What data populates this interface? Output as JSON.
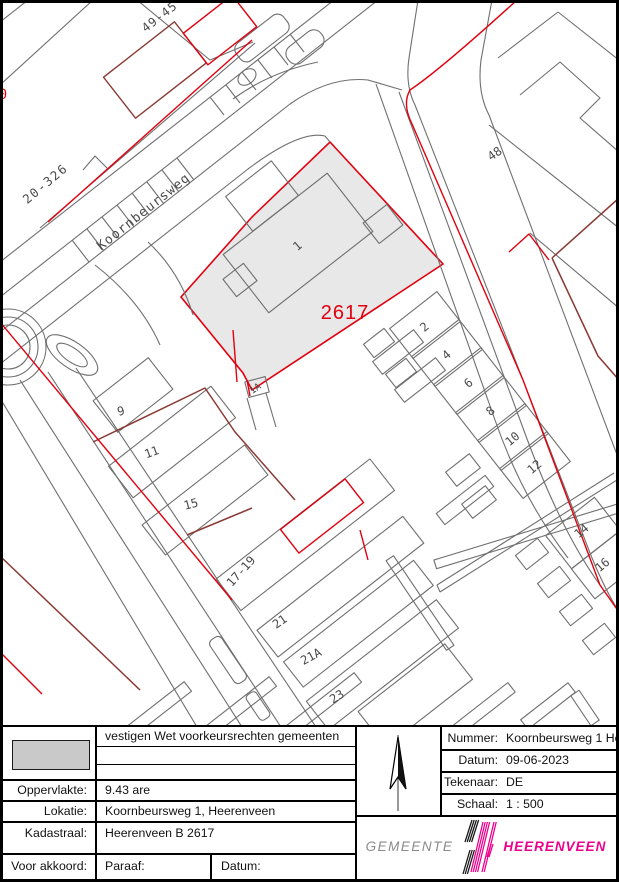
{
  "map": {
    "colors": {
      "gray_line": "#6f6f6f",
      "red": "#e2000f",
      "maroon": "#8a3a34",
      "parcel_fill": "#e8e8e8",
      "label": "#4a4a4a",
      "parcel_number_red": "#e2000f"
    },
    "street_label": "Koornbeursweg",
    "subject_parcel_number": "2617",
    "labels": [
      {
        "text": "0",
        "x": 3,
        "y": 99,
        "rot": 0,
        "size": 14,
        "color": "#e2000f"
      },
      {
        "text": "49-45",
        "x": 162,
        "y": 20,
        "rot": -38,
        "size": 12,
        "ls": 1
      },
      {
        "text": "20-326",
        "x": 48,
        "y": 187,
        "rot": -40,
        "size": 12.5,
        "ls": 1.5
      },
      {
        "text": "Koornbeursweg",
        "x": 146,
        "y": 215,
        "rot": -38.5,
        "size": 13,
        "ls": 1
      },
      {
        "text": "48",
        "x": 497,
        "y": 157,
        "rot": -35,
        "size": 12
      },
      {
        "text": "1",
        "x": 300,
        "y": 249,
        "rot": -40,
        "size": 12
      },
      {
        "text": "2617",
        "x": 345,
        "y": 319,
        "rot": 0,
        "size": 20,
        "color": "#e2000f",
        "font": "sans",
        "ls": 1
      },
      {
        "text": "1A",
        "x": 257,
        "y": 391,
        "rot": -35,
        "size": 9.5
      },
      {
        "text": "2",
        "x": 427,
        "y": 330,
        "rot": -40,
        "size": 12
      },
      {
        "text": "4",
        "x": 449,
        "y": 358,
        "rot": -40,
        "size": 12
      },
      {
        "text": "6",
        "x": 471,
        "y": 386,
        "rot": -40,
        "size": 12
      },
      {
        "text": "8",
        "x": 493,
        "y": 414,
        "rot": -40,
        "size": 12
      },
      {
        "text": "10",
        "x": 515,
        "y": 442,
        "rot": -40,
        "size": 12
      },
      {
        "text": "12",
        "x": 537,
        "y": 470,
        "rot": -40,
        "size": 12
      },
      {
        "text": "9",
        "x": 122,
        "y": 415,
        "rot": -15,
        "size": 12
      },
      {
        "text": "11",
        "x": 153,
        "y": 456,
        "rot": -20,
        "size": 12
      },
      {
        "text": "15",
        "x": 192,
        "y": 508,
        "rot": -15,
        "size": 12
      },
      {
        "text": "17-19",
        "x": 244,
        "y": 574,
        "rot": -48,
        "size": 12
      },
      {
        "text": "21",
        "x": 282,
        "y": 625,
        "rot": -35,
        "size": 12
      },
      {
        "text": "21A",
        "x": 313,
        "y": 660,
        "rot": -28,
        "size": 12
      },
      {
        "text": "23",
        "x": 339,
        "y": 700,
        "rot": -32,
        "size": 12
      },
      {
        "text": "14",
        "x": 584,
        "y": 534,
        "rot": -40,
        "size": 12
      },
      {
        "text": "16",
        "x": 605,
        "y": 568,
        "rot": -40,
        "size": 12
      }
    ]
  },
  "title_block": {
    "left": {
      "purpose": "vestigen Wet voorkeursrechten gemeenten",
      "legend_swatch_color": "#c9c9c9",
      "rows": [
        {
          "label": "Oppervlakte:",
          "value": "9.43 are"
        },
        {
          "label": "Lokatie:",
          "value": "Koornbeursweg 1, Heerenveen"
        },
        {
          "label": "Kadastraal:",
          "value": "Heerenveen B 2617"
        }
      ],
      "approval": {
        "label": "Voor akkoord:",
        "paraaf": "Paraaf:",
        "datum": "Datum:"
      }
    },
    "right": {
      "rows": [
        {
          "label": "Nummer:",
          "value": "Koornbeursweg 1 Heere"
        },
        {
          "label": "Datum:",
          "value": "09-06-2023"
        },
        {
          "label": "Tekenaar:",
          "value": "DE"
        },
        {
          "label": "Schaal:",
          "value": "1 : 500"
        }
      ]
    },
    "logo": {
      "gemeente": "GEMEENTE",
      "heerenveen": "HEERENVEEN",
      "magenta": "#ec008c"
    }
  }
}
